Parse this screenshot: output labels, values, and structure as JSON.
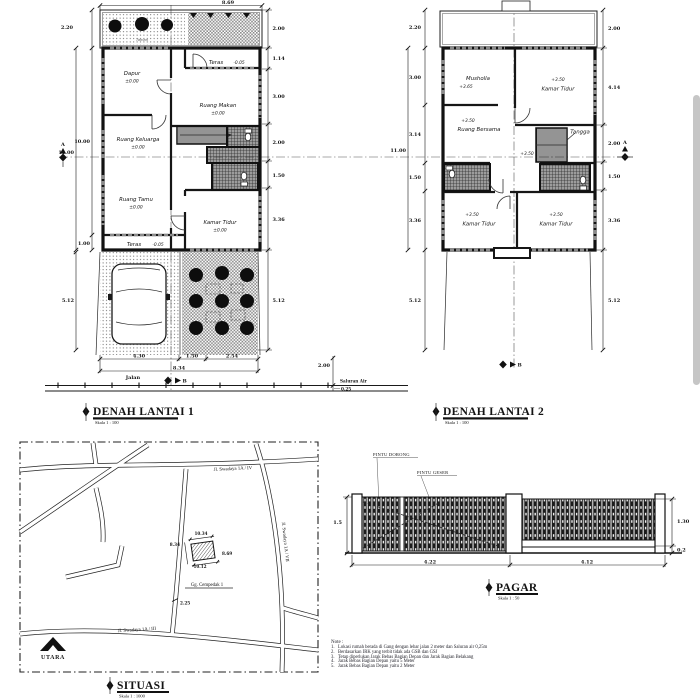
{
  "plan1": {
    "title": "DENAH LANTAI 1",
    "scale": "Skala 1 : 100",
    "section_marker": "A",
    "road_marker": "B",
    "garden_label": "Taman",
    "rooms": [
      {
        "name": "Dapur",
        "level": "±0.00"
      },
      {
        "name": "Teras",
        "level": "-0.05"
      },
      {
        "name": "Ruang Makan",
        "level": "±0.00"
      },
      {
        "name": "Ruang Keluarga",
        "level": "±0.00"
      },
      {
        "name": "Ruang Tamu",
        "level": "±0.00"
      },
      {
        "name": "Kamar Tidur",
        "level": "±0.00"
      },
      {
        "name": "Teras",
        "level": "-0.05"
      }
    ],
    "dims": {
      "top": "8.69",
      "left": [
        "2.20",
        "10.00",
        "11.00",
        "1.00",
        "5.12"
      ],
      "right": [
        "2.00",
        "1.14",
        "3.00",
        "2.00",
        "1.50",
        "3.36",
        "5.12"
      ],
      "bottom": [
        "4.30",
        "1.50",
        "2.54",
        "8.34"
      ],
      "road_width": "2.00"
    },
    "road_label": "Jalan",
    "drain_label": "Saluran Air",
    "drain_size": "0.25"
  },
  "plan2": {
    "title": "DENAH LANTAI 2",
    "scale": "Skala 1 : 100",
    "section_marker": "A",
    "road_marker": "B",
    "stair_label": "Tangga",
    "stair_level": "+3.50",
    "rooms": [
      {
        "name": "Musholla",
        "level": "+3.65"
      },
      {
        "name": "Kamar Tidur",
        "level": "+3.50"
      },
      {
        "name": "Ruang Bersama",
        "level": "+3.50"
      },
      {
        "name": "Kamar Tidur",
        "level": "+3.50"
      },
      {
        "name": "Kamar Tidur",
        "level": "+3.50"
      }
    ],
    "dims": {
      "left": [
        "2.20",
        "3.00",
        "3.14",
        "1.50",
        "3.36",
        "11.00",
        "5.12"
      ],
      "right": [
        "2.00",
        "4.14",
        "2.00",
        "1.50",
        "3.36",
        "5.12"
      ]
    }
  },
  "situasi": {
    "title": "SITUASI",
    "scale": "Skala 1 : 1000",
    "road_top": "Jl. Swadaya 1A / IV",
    "road_right": "Jl. Swadaya 1A / VII",
    "road_bottom": "Jl. Swadaya 1A / III",
    "lane": "Gg. Cempedak 1",
    "lane_width": "2.25",
    "north_label": "UTARA",
    "plot": {
      "top": "10.34",
      "left": "8.34",
      "bottom": "10.12",
      "right": "8.69"
    }
  },
  "pagar": {
    "title": "PAGAR",
    "scale": "Skala 1 : 50",
    "door_label_1": "PINTU DORONG",
    "door_label_2": "PINTU GESER",
    "dims": {
      "left_height": "1.5",
      "right_height": "1.30",
      "base_height": "0.2",
      "bottom": [
        "4.22",
        "4.12"
      ]
    }
  },
  "notes": {
    "heading": "Note :",
    "items": [
      "1.   Lokasi rumah berada di Gang dengan lebar jalan 2 meter dan Saluran air 0,25m",
      "2.   Berdasarkan IRK yang terbit tidak ada GSB dan GSJ",
      "3.   Tetap diperlukan Jarak Bebas Bagian Depan dan Jarak Bagian Belakang",
      "4.   Jarak Bebas Bagian Depan yaitu 5 Meter",
      "5.   Jarak Bebas Bagian Depan yaitu 2 Meter"
    ]
  }
}
